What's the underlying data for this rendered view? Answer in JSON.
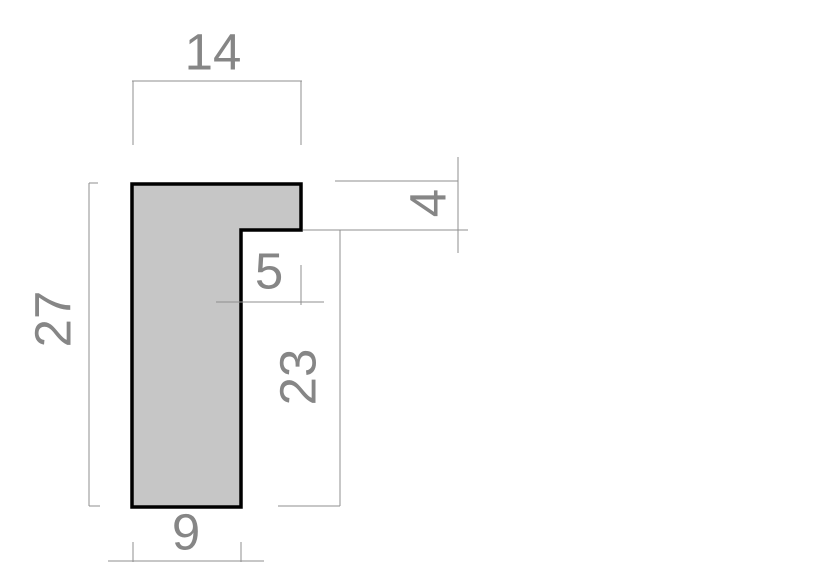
{
  "drawing": {
    "description": "L-shaped moulding profile cross-section with dimensions",
    "shape": {
      "name": "l-profile-cross-section",
      "fill": "#c6c6c6",
      "stroke": "#000000"
    },
    "colors": {
      "background": "#ffffff",
      "dimension_line": "#8f8f8f",
      "dimension_text": "#868686"
    },
    "dimensions": {
      "top_width": "14",
      "overall_height": "27",
      "rabbet_height": "4",
      "rabbet_width": "5",
      "lower_inner_height": "23",
      "bottom_width": "9"
    }
  }
}
